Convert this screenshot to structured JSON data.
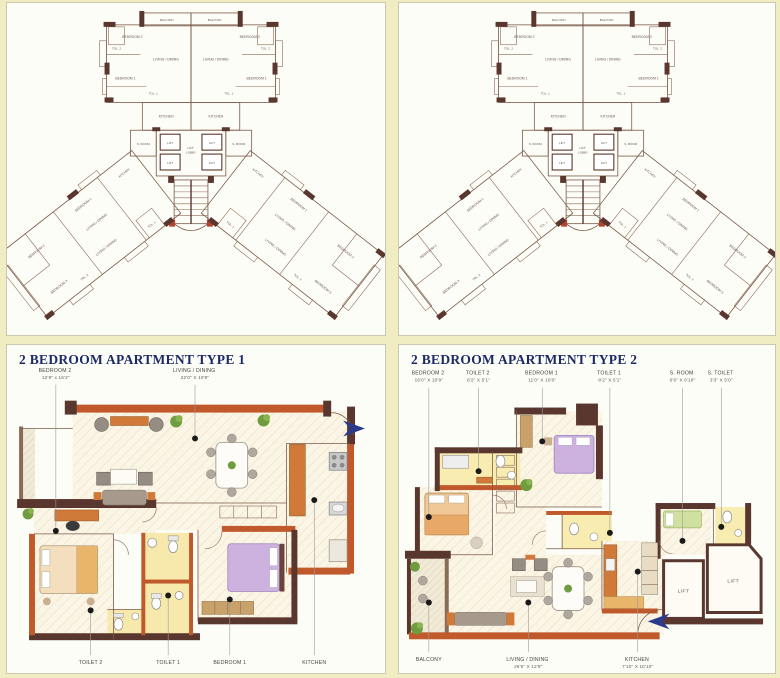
{
  "page": {
    "background": "#f0edc2",
    "accent_orange": "#c05a2c",
    "wall_dark": "#5a372e",
    "title_navy": "#1c2a66"
  },
  "tower_plan": {
    "room_labels": {
      "balcony": "BALCONY",
      "bedroom1": "BEDROOM 1",
      "bedroom2": "BEDROOM 2",
      "bedroom3": "BEDROOM 3",
      "living_dining": "LIVING / DINING",
      "toilet1": "TOL. 1",
      "toilet2": "TOL. 2",
      "kitchen": "KITCHEN",
      "servant_room": "S. ROOM",
      "lift": "LIFT",
      "lift_lobby_line1": "LIFT",
      "lift_lobby_line2": "LOBBY"
    }
  },
  "type1": {
    "title": "2 BEDROOM APARTMENT TYPE 1",
    "callouts_top": [
      {
        "label": "BEDROOM 2",
        "dims": "12'9\" x 16'2\""
      },
      {
        "label": "LIVING / DINING",
        "dims": "22'0\" X 10'9\""
      }
    ],
    "callouts_bottom": [
      {
        "label": "TOILET 2"
      },
      {
        "label": "TOILET 1"
      },
      {
        "label": "BEDROOM 1"
      },
      {
        "label": "KITCHEN"
      }
    ]
  },
  "type2": {
    "title": "2 BEDROOM APARTMENT TYPE 2",
    "lift_label": "LIFT",
    "callouts_top": [
      {
        "label": "BEDROOM 2",
        "dims": "16'0\" X 10'9\""
      },
      {
        "label": "TOILET 2",
        "dims": "8'2\" X 5'1\""
      },
      {
        "label": "BEDROOM 1",
        "dims": "11'0\" X 10'0\""
      },
      {
        "label": "TOILET 1",
        "dims": "8'2\" X 5'1\""
      },
      {
        "label": "S. ROOM",
        "dims": "6'6\" X 6'10\""
      },
      {
        "label": "S. TOILET",
        "dims": "3'3\" X 5'0\""
      }
    ],
    "callouts_bottom": [
      {
        "label": "BALCONY",
        "dims": ""
      },
      {
        "label": "LIVING / DINING",
        "dims": "26'5\" X 12'9\""
      },
      {
        "label": "KITCHEN",
        "dims": "7'10\" X 10'10\""
      }
    ]
  }
}
